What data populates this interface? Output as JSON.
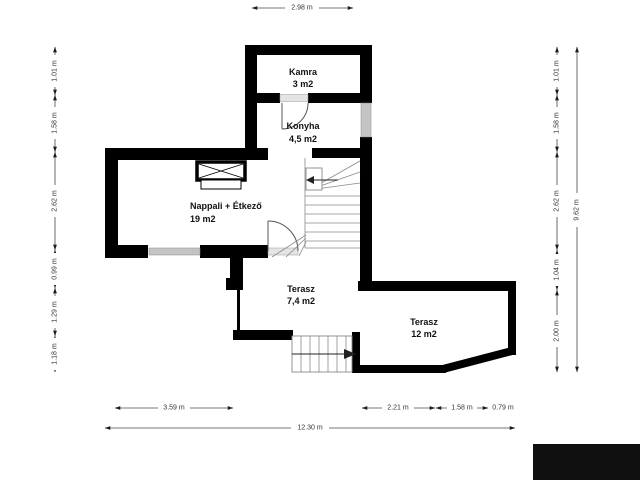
{
  "rooms": [
    {
      "name": "Kamra",
      "area": "3 m2"
    },
    {
      "name": "Konyha",
      "area": "4,5 m2"
    },
    {
      "name": "Nappali + Étkező",
      "area": "19 m2"
    },
    {
      "name": "Terasz",
      "area": "7,4 m2"
    },
    {
      "name": "Terasz",
      "area": "12 m2"
    }
  ],
  "dimensions": {
    "top": [
      "2.98 m"
    ],
    "left": [
      "1.01 m",
      "1.58 m",
      "2.62 m",
      "0.99 m",
      "1.29 m",
      "1.18 m"
    ],
    "right": [
      "1.01 m",
      "1.58 m",
      "2.62 m",
      "1.04 m",
      "2.00 m"
    ],
    "right_total": "9.62 m",
    "bottom": [
      "3.59 m",
      "2.21 m",
      "1.58 m",
      "0.79 m"
    ],
    "bottom_total": "12.30 m"
  },
  "colors": {
    "wall": "#000000",
    "window": "#c4c4c4",
    "background": "#ffffff",
    "watermark": "#101010"
  }
}
